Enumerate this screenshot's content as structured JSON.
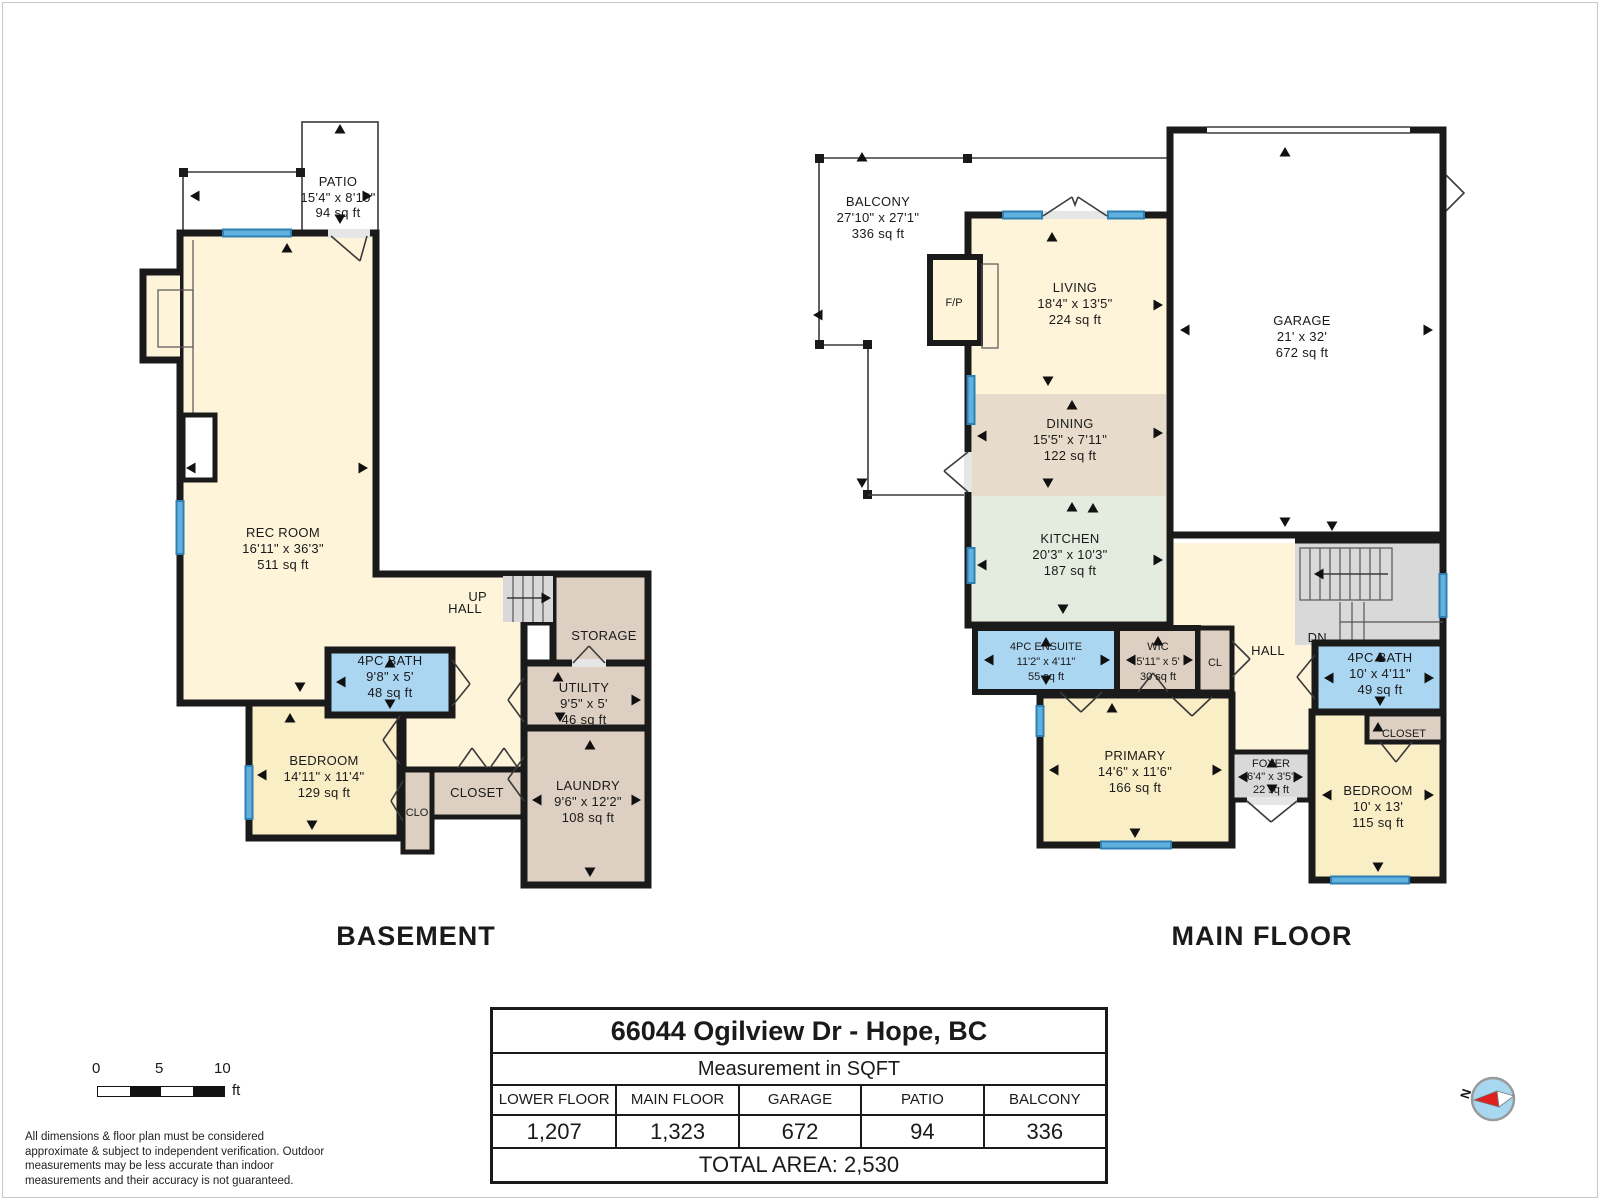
{
  "floors": {
    "basement": {
      "title": "BASEMENT",
      "rooms": {
        "patio": {
          "name": "PATIO",
          "dims": "15'4\" x 8'10\"",
          "area": "94 sq ft"
        },
        "rec_room": {
          "name": "REC ROOM",
          "dims": "16'11\" x 36'3\"",
          "area": "511 sq ft"
        },
        "hall": {
          "name": "HALL"
        },
        "up": {
          "name": "UP"
        },
        "storage": {
          "name": "STORAGE"
        },
        "utility": {
          "name": "UTILITY",
          "dims": "9'5\" x 5'",
          "area": "46 sq ft"
        },
        "bath": {
          "name": "4PC BATH",
          "dims": "9'8\" x 5'",
          "area": "48 sq ft"
        },
        "bedroom": {
          "name": "BEDROOM",
          "dims": "14'11\" x 11'4\"",
          "area": "129 sq ft"
        },
        "clo": {
          "name": "CLO"
        },
        "closet": {
          "name": "CLOSET"
        },
        "laundry": {
          "name": "LAUNDRY",
          "dims": "9'6\" x 12'2\"",
          "area": "108 sq ft"
        }
      }
    },
    "main": {
      "title": "MAIN FLOOR",
      "rooms": {
        "balcony": {
          "name": "BALCONY",
          "dims": "27'10\" x 27'1\"",
          "area": "336 sq ft"
        },
        "fp": {
          "name": "F/P"
        },
        "living": {
          "name": "LIVING",
          "dims": "18'4\" x 13'5\"",
          "area": "224 sq ft"
        },
        "garage": {
          "name": "GARAGE",
          "dims": "21' x 32'",
          "area": "672 sq ft"
        },
        "dining": {
          "name": "DINING",
          "dims": "15'5\" x 7'11\"",
          "area": "122 sq ft"
        },
        "kitchen": {
          "name": "KITCHEN",
          "dims": "20'3\" x 10'3\"",
          "area": "187 sq ft"
        },
        "ensuite": {
          "name": "4PC ENSUITE",
          "dims": "11'2\" x 4'11\"",
          "area": "55 sq ft"
        },
        "wic": {
          "name": "WIC",
          "dims": "5'11\" x 5'",
          "area": "30 sq ft"
        },
        "cl": {
          "name": "CL"
        },
        "hall": {
          "name": "HALL"
        },
        "dn": {
          "name": "DN"
        },
        "bath": {
          "name": "4PC BATH",
          "dims": "10' x 4'11\"",
          "area": "49 sq ft"
        },
        "primary": {
          "name": "PRIMARY",
          "dims": "14'6\" x 11'6\"",
          "area": "166 sq ft"
        },
        "foyer": {
          "name": "FOYER",
          "dims": "6'4\" x 3'5\"",
          "area": "22 sq ft"
        },
        "closet": {
          "name": "CLOSET"
        },
        "bedroom": {
          "name": "BEDROOM",
          "dims": "10' x 13'",
          "area": "115 sq ft"
        }
      }
    }
  },
  "summary_table": {
    "title": "66044 Ogilview Dr -  Hope, BC",
    "subtitle": "Measurement in SQFT",
    "columns": [
      "LOWER FLOOR",
      "MAIN FLOOR",
      "GARAGE",
      "PATIO",
      "BALCONY"
    ],
    "values": [
      "1,207",
      "1,323",
      "672",
      "94",
      "336"
    ],
    "total": "TOTAL AREA: 2,530"
  },
  "scale_bar": {
    "ticks": [
      "0",
      "5",
      "10"
    ],
    "unit": "ft"
  },
  "disclaimer": "All dimensions & floor plan must be considered approximate & subject to independent verification.  Outdoor measurements may be less accurate than indoor measurements and their accuracy is not guaranteed.",
  "compass": {
    "label": "N"
  },
  "colors": {
    "wall": "#1a1a1a",
    "room_cream": "#fdf4da",
    "room_yellow": "#faeec6",
    "room_taupe": "#ddd0c2",
    "room_dining": "#e7dccb",
    "room_kitchen": "#e3ecdf",
    "room_bath_blue": "#abd6f2",
    "stairs_grey": "#d9d9d9",
    "window_blue": "#4aa3d8",
    "compass_blue": "#a8d8f0",
    "compass_needle_red": "#e02020"
  }
}
